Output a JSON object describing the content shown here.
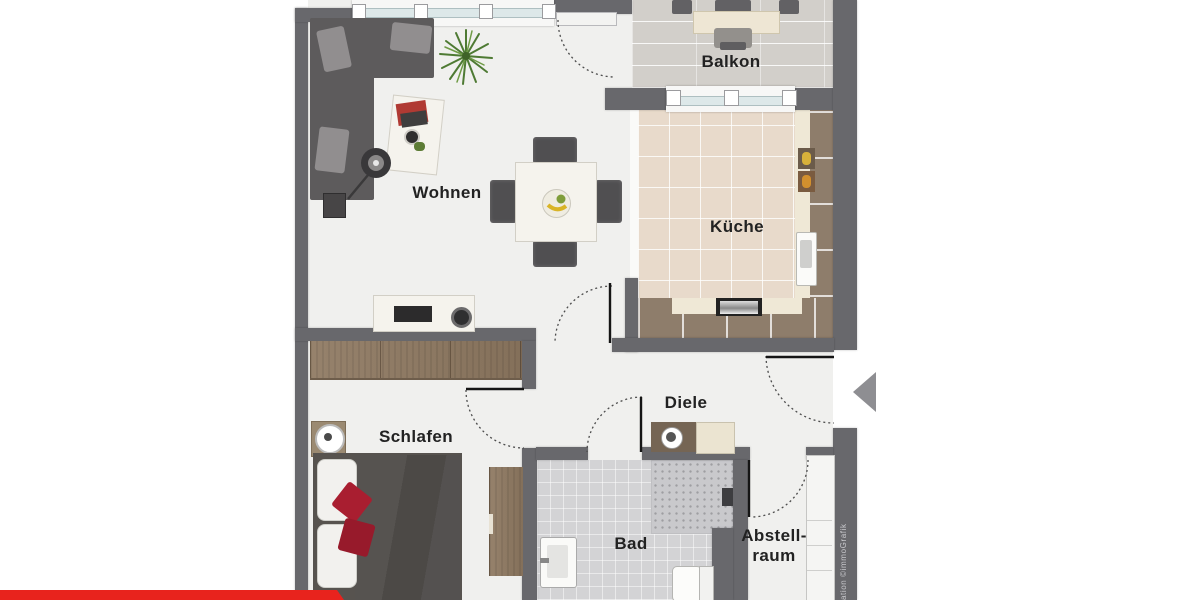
{
  "rooms": {
    "wohnen": {
      "label": "Wohnen"
    },
    "balkon": {
      "label": "Balkon"
    },
    "kueche": {
      "label": "Küche"
    },
    "schlafen": {
      "label": "Schlafen"
    },
    "diele": {
      "label": "Diele"
    },
    "bad": {
      "label": "Bad"
    },
    "abstellraum": {
      "label_line1": "Abstell-",
      "label_line2": "raum"
    }
  },
  "watermark": {
    "text": "ation ©immoGrafik"
  },
  "icons": {
    "entrance": "entrance-arrow-left"
  },
  "colors": {
    "wall": "#68686c",
    "floor": "#f0f0ee",
    "balcony_floor": "#d2cfca",
    "kitchen_floor": "#e8dacb",
    "bath_floor": "#d3d3d5",
    "counter_cream": "#efe8d6",
    "counter_brown": "#8e7d6b",
    "wood": "#8b7660",
    "sofa": "#5d5b5c",
    "accent_red": "#e8231d",
    "cushion_red": "#a91e30",
    "label_text": "#222222"
  }
}
